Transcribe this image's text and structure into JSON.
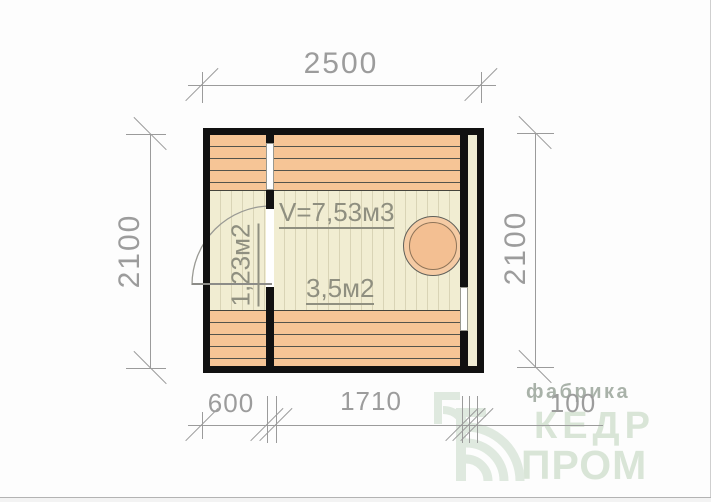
{
  "plan": {
    "dim_top": "2500",
    "dim_left": "2100",
    "dim_right": "2100",
    "dim_bottom_left": "600",
    "dim_bottom_mid": "1710",
    "dim_bottom_right": "100",
    "label_volume": "V=7,53м3",
    "label_area_small": "1,23м2",
    "label_area_main": "3,5м2",
    "colors": {
      "wall": "#111111",
      "bench": "#f6c596",
      "floor": "#f1edd2",
      "stove": "#f3bf92",
      "dimension": "#9b9b9b",
      "room_text": "#8f8f80"
    }
  },
  "watermark": {
    "factory_label": "фабрика",
    "brand_top": "КЕДР",
    "brand_bottom": "ПРОМ",
    "color": "#d9e5d7"
  }
}
